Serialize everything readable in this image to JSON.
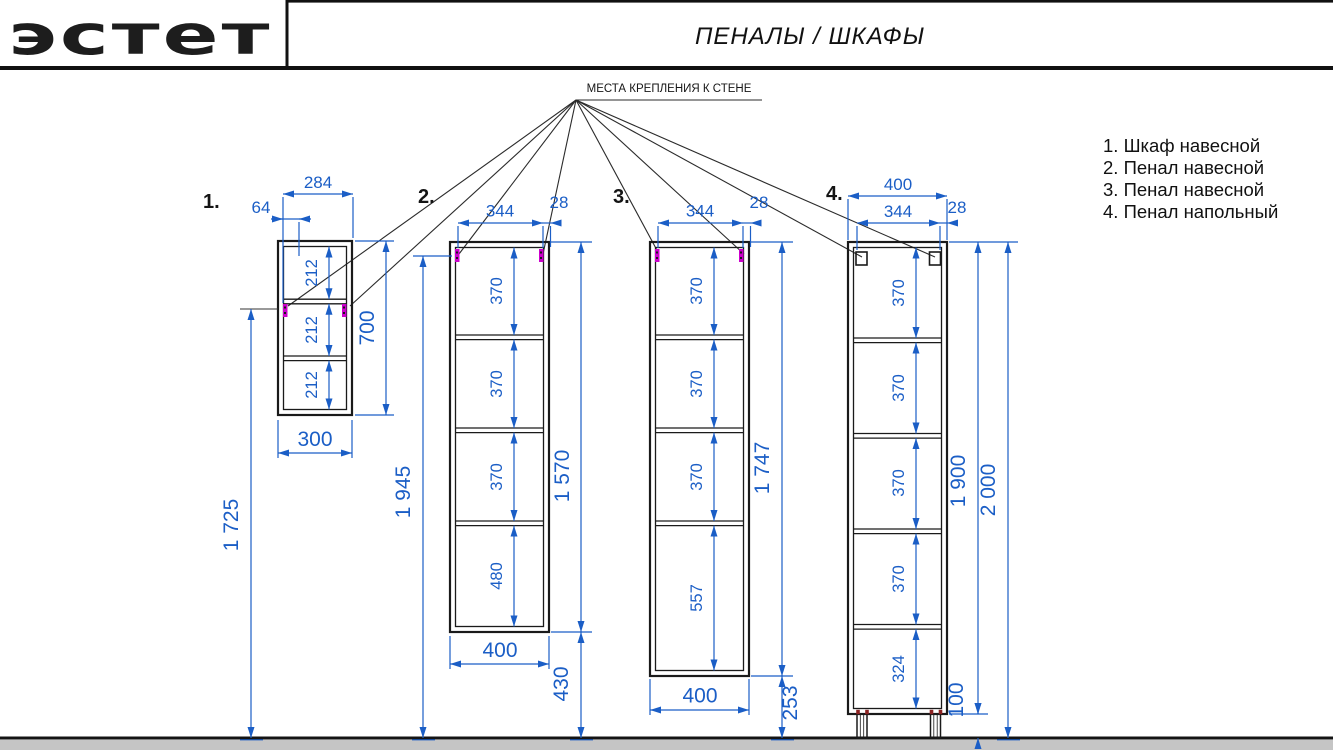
{
  "header": {
    "logo": "эстет",
    "title": "ПЕНАЛЫ / ШКАФЫ"
  },
  "annotation": {
    "wall_mount": "МЕСТА КРЕПЛЕНИЯ К СТЕНЕ"
  },
  "legend": {
    "items": [
      "1. Шкаф навесной",
      "2. Пенал навесной",
      "3. Пенал навесной",
      "4. Пенал напольный"
    ]
  },
  "colors": {
    "dimension_blue": "#1b5ec6",
    "mount_magenta": "#cc00cc",
    "line_black": "#1a1a1a",
    "floor_gray": "#c5c5c5"
  },
  "cabinets": [
    {
      "num": "1.",
      "name": "Шкаф навесной",
      "dims": {
        "top_width": "284",
        "mount_offset": "64",
        "height": "700",
        "bottom_width": "300",
        "mount_height": "1 725",
        "compartments": [
          "212",
          "212",
          "212"
        ]
      }
    },
    {
      "num": "2.",
      "name": "Пенал навесной",
      "dims": {
        "mount_span": "344",
        "mount_edge": "28",
        "height": "1 570",
        "floor_clearance": "430",
        "mount_height": "1 945",
        "bottom_width": "400",
        "compartments": [
          "370",
          "370",
          "370",
          "480"
        ]
      }
    },
    {
      "num": "3.",
      "name": "Пенал навесной",
      "dims": {
        "mount_span": "344",
        "mount_edge": "28",
        "height": "1 747",
        "floor_clearance": "253",
        "bottom_width": "400",
        "compartments": [
          "370",
          "370",
          "370",
          "557"
        ]
      }
    },
    {
      "num": "4.",
      "name": "Пенал напольный",
      "dims": {
        "top_width": "400",
        "mount_span": "344",
        "mount_edge": "28",
        "body_height": "1 900",
        "total_height": "2 000",
        "leg_height": "100",
        "compartments": [
          "370",
          "370",
          "370",
          "370",
          "324"
        ]
      }
    }
  ]
}
